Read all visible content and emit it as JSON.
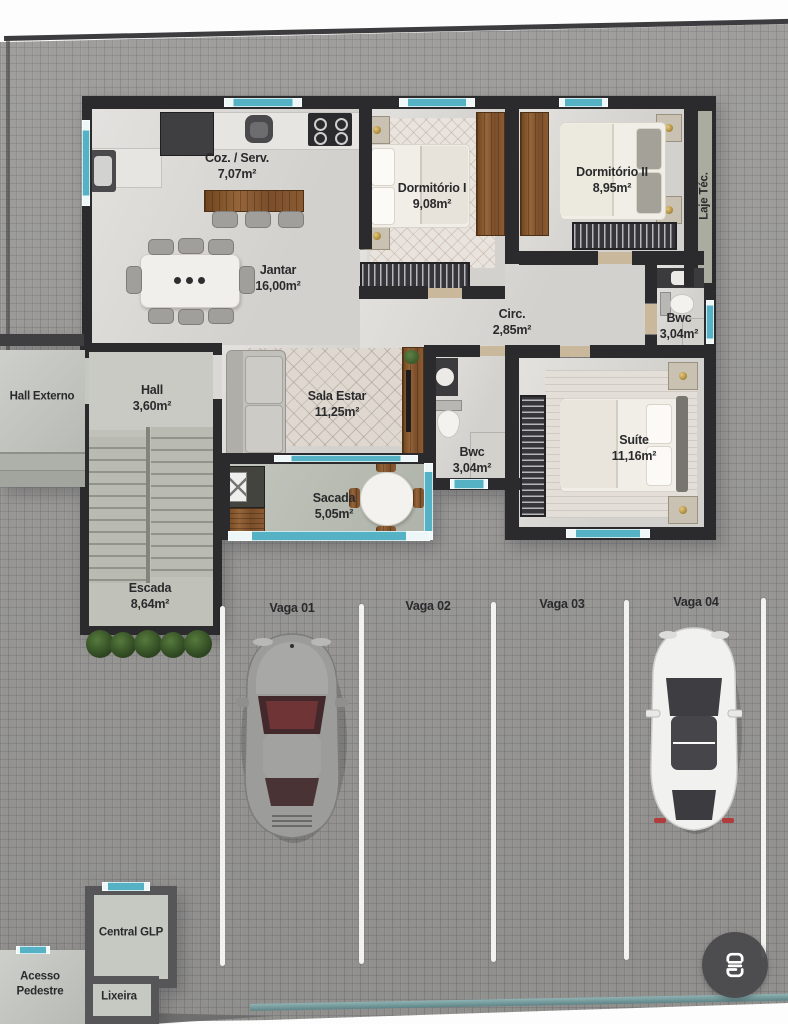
{
  "rooms": {
    "coz": {
      "name": "Coz. / Serv.",
      "area": "7,07m²"
    },
    "jantar": {
      "name": "Jantar",
      "area": "16,00m²"
    },
    "dorm1": {
      "name": "Dormitório I",
      "area": "9,08m²"
    },
    "dorm2": {
      "name": "Dormitório II",
      "area": "8,95m²"
    },
    "laje": {
      "name": "Laje Téc."
    },
    "circ": {
      "name": "Circ.",
      "area": "2,85m²"
    },
    "bwc_top": {
      "name": "Bwc",
      "area": "3,04m²"
    },
    "bwc_social": {
      "name": "Bwc",
      "area": "3,04m²"
    },
    "sala": {
      "name": "Sala Estar",
      "area": "11,25m²"
    },
    "suite": {
      "name": "Suíte",
      "area": "11,16m²"
    },
    "sacada": {
      "name": "Sacada",
      "area": "5,05m²"
    },
    "hall": {
      "name": "Hall",
      "area": "3,60m²"
    },
    "escada": {
      "name": "Escada",
      "area": "8,64m²"
    },
    "hall_externo": {
      "name": "Hall Externo"
    }
  },
  "parking": {
    "spots": [
      {
        "label": "Vaga 01",
        "occupied": true,
        "car_color": "gray"
      },
      {
        "label": "Vaga 02",
        "occupied": false
      },
      {
        "label": "Vaga 03",
        "occupied": false
      },
      {
        "label": "Vaga 04",
        "occupied": true,
        "car_color": "white"
      }
    ]
  },
  "outbuildings": {
    "central_glp": {
      "name": "Central GLP"
    },
    "acesso_pedestre": {
      "name": "Acesso Pedestre"
    },
    "lixeira": {
      "name": "Lixeira"
    }
  },
  "overlay": {
    "scan_button_icon": "text-scan-icon"
  },
  "colors": {
    "wall": "#2b2b2d",
    "window_teal": "#55b2c4",
    "floor_light": "#dad8d4",
    "paver": "#9b9a98",
    "wood": "#8a5a33",
    "parking_line": "#f2f2f0",
    "car_gray": "#9c9c9a",
    "car_white": "#f0f0ee",
    "fab": "#4a4a4a"
  }
}
